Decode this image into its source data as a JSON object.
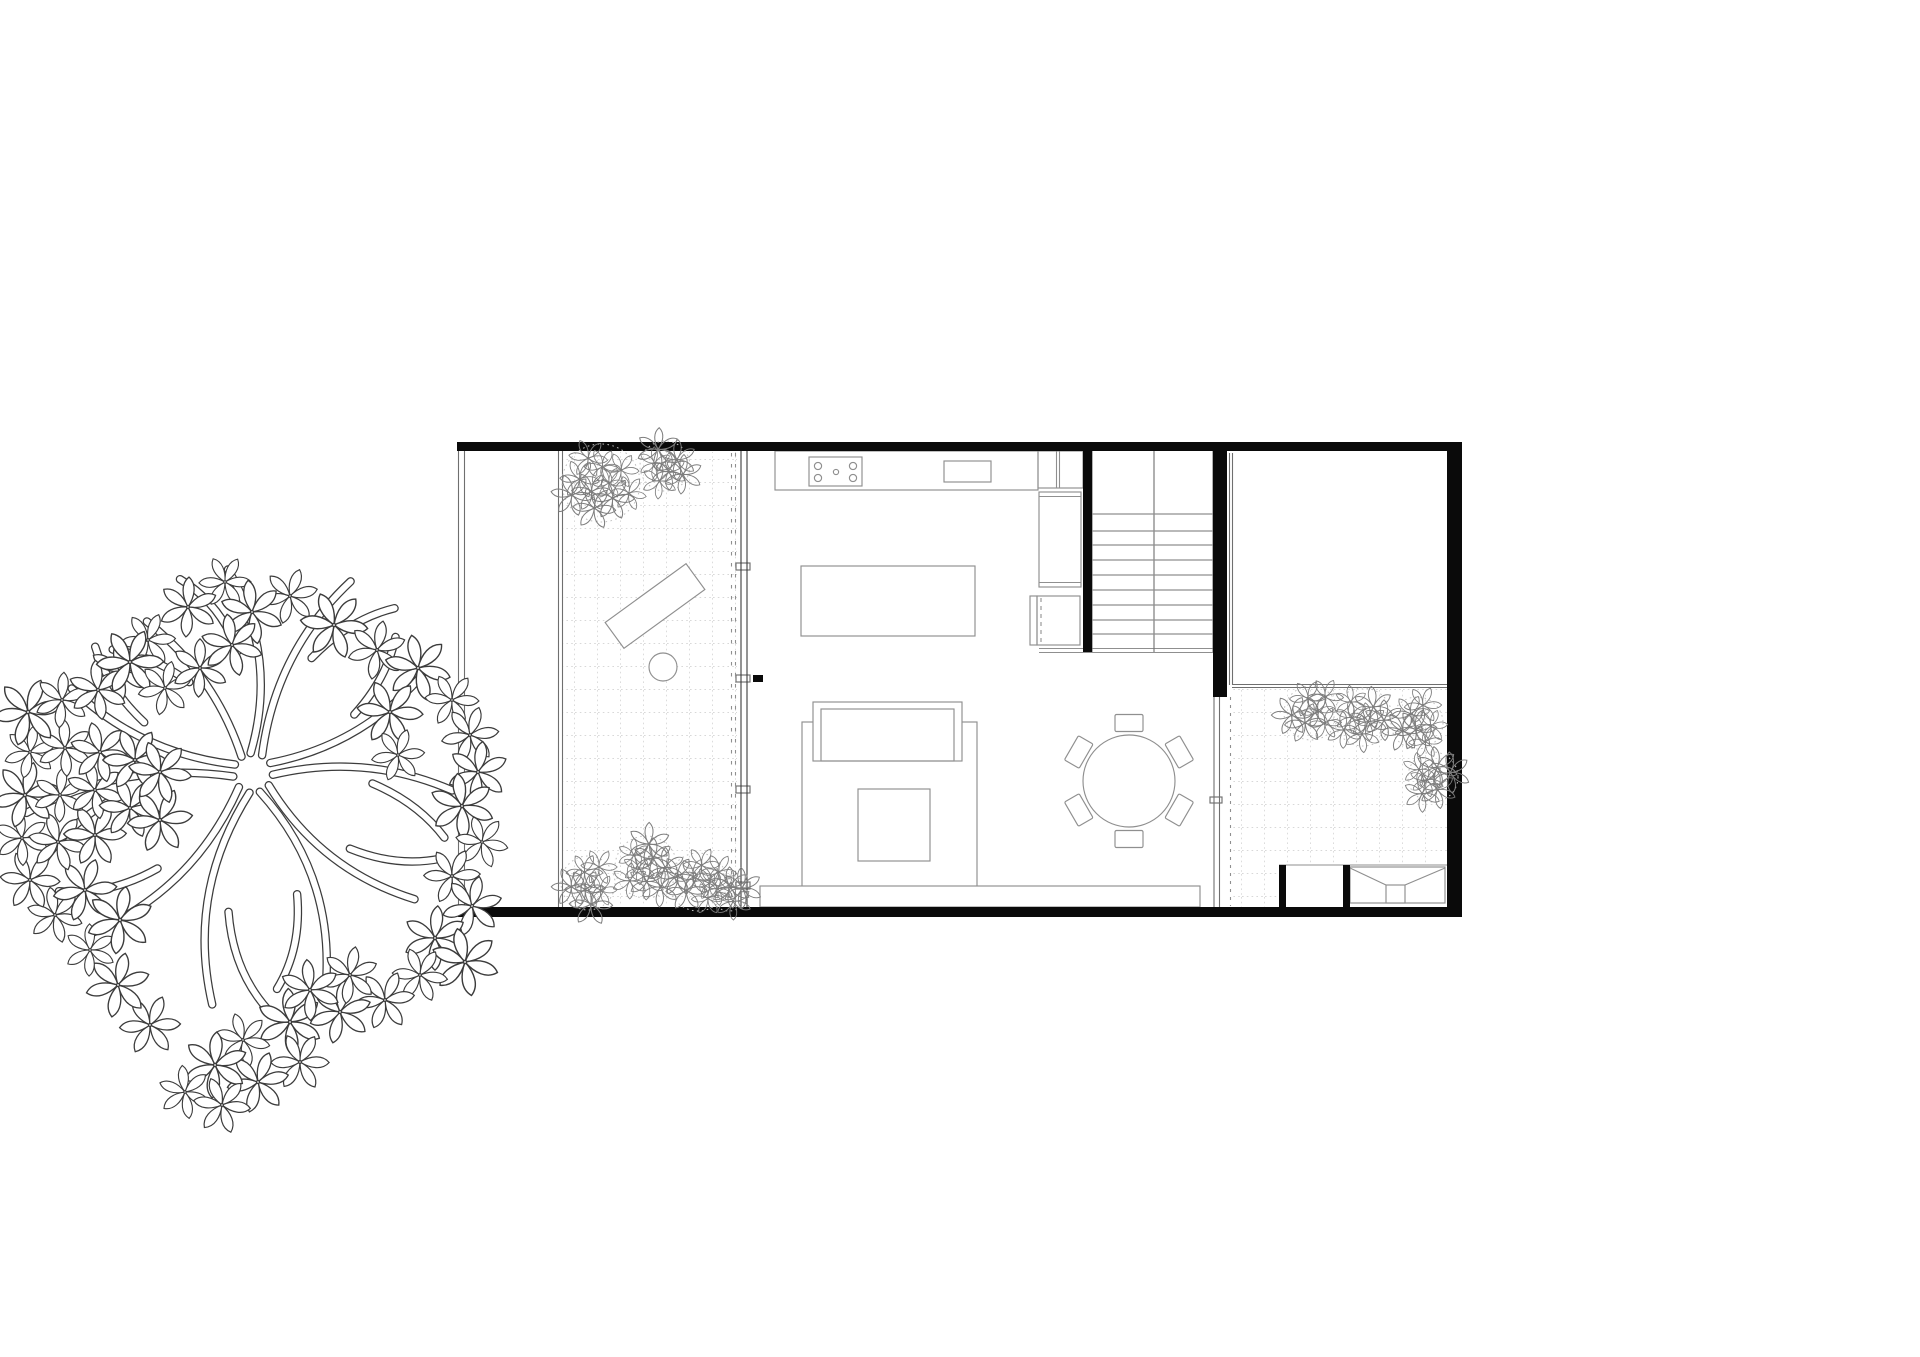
{
  "palette": {
    "paper": "#ffffff",
    "wall": "#0a0a0a",
    "line_strong": "#3c3c3c",
    "line_mid": "#6f6f6f",
    "line_soft": "#8f8f8f",
    "grid": "#d8d8d8",
    "foliage": "#7d7d7d",
    "foliage_halo": "#c0c0c0"
  },
  "canvas": {
    "w": 1920,
    "h": 1357
  },
  "legend": {
    "drawing": "house-floor-plan",
    "tree": "existing-tree",
    "west_courtyard": "paved-courtyard-with-planting",
    "east_courtyard": "paved-courtyard-with-planting",
    "stair_treads": 9,
    "cooktop_burners": 4,
    "dining_chairs": 6
  },
  "walls": [
    {
      "name": "wall-north",
      "x": 457,
      "y": 442,
      "w": 998,
      "h": 9
    },
    {
      "name": "wall-south",
      "x": 458,
      "y": 907,
      "w": 1004,
      "h": 10
    },
    {
      "name": "wall-east",
      "x": 1447,
      "y": 442,
      "w": 15,
      "h": 475
    },
    {
      "name": "wall-stair-west",
      "x": 1083,
      "y": 449,
      "w": 9,
      "h": 203
    },
    {
      "name": "wall-stair-east",
      "x": 1213,
      "y": 451,
      "w": 14,
      "h": 246
    },
    {
      "name": "pier-storage-west",
      "x": 1279,
      "y": 865,
      "w": 7,
      "h": 43
    },
    {
      "name": "pier-storage-mid",
      "x": 1343,
      "y": 865,
      "w": 7,
      "h": 43
    },
    {
      "name": "facade-post",
      "x": 753,
      "y": 675,
      "w": 10,
      "h": 7
    }
  ],
  "double_lines": [
    {
      "name": "site-boundary-west",
      "x1": 458.5,
      "y1": 442,
      "x2": 458.5,
      "y2": 917,
      "gap": 6,
      "c": "mid"
    },
    {
      "name": "courtyard-west-edge",
      "x1": 558.5,
      "y1": 451,
      "x2": 558.5,
      "y2": 907,
      "gap": 4,
      "c": "mid"
    },
    {
      "name": "glass-facade-west",
      "x1": 741,
      "y1": 451,
      "x2": 741,
      "y2": 907,
      "gap": 6,
      "c": "strong"
    },
    {
      "name": "glass-partition-east",
      "x1": 1229.5,
      "y1": 453,
      "x2": 1229.5,
      "y2": 685,
      "gap": 3,
      "c": "mid"
    },
    {
      "name": "court-divider-east",
      "x1": 1232,
      "y1": 684.5,
      "x2": 1449,
      "y2": 684.5,
      "gap": 3,
      "c": "mid"
    },
    {
      "name": "track-south-east",
      "x1": 1214,
      "y1": 697,
      "x2": 1214,
      "y2": 907,
      "gap": 5.5,
      "c": "mid"
    },
    {
      "name": "stair-base-line",
      "x1": 1039,
      "y1": 648.5,
      "x2": 1213,
      "y2": 648.5,
      "gap": 4,
      "c": "soft"
    },
    {
      "name": "cabinet-divider",
      "x1": 1056.5,
      "y1": 451,
      "x2": 1056.5,
      "y2": 488,
      "gap": 3,
      "c": "soft"
    }
  ],
  "dashed_lines": [
    {
      "name": "curtain-dash-a",
      "x1": 731.5,
      "y1": 453,
      "x2": 731.5,
      "y2": 905,
      "dash": "3.5,7.5",
      "c": "soft"
    },
    {
      "name": "curtain-dash-b",
      "x1": 735.5,
      "y1": 453,
      "x2": 735.5,
      "y2": 905,
      "dash": "3.5,7.5",
      "c": "soft"
    },
    {
      "name": "track-dash-east",
      "x1": 1230.5,
      "y1": 697,
      "x2": 1230.5,
      "y2": 906,
      "dash": "3,5",
      "c": "soft"
    },
    {
      "name": "oven-door-dash",
      "x1": 1041,
      "y1": 598,
      "x2": 1041,
      "y2": 644,
      "dash": "4,4",
      "c": "soft"
    }
  ],
  "lines": [
    {
      "name": "storage-top-line",
      "x1": 1279,
      "y1": 865,
      "x2": 1453,
      "y2": 865,
      "c": "soft"
    },
    {
      "name": "fireplace-diag-left",
      "x1": 1350,
      "y1": 868,
      "x2": 1386,
      "y2": 885,
      "c": "soft"
    },
    {
      "name": "fireplace-diag-right",
      "x1": 1445,
      "y1": 868,
      "x2": 1405,
      "y2": 885,
      "c": "soft"
    },
    {
      "name": "tall-cabinet-top-inner",
      "x1": 1039,
      "y1": 496.5,
      "x2": 1081,
      "y2": 496.5,
      "c": "soft"
    },
    {
      "name": "tall-cabinet-bottom-inner",
      "x1": 1039,
      "y1": 582.5,
      "x2": 1081,
      "y2": 582.5,
      "c": "soft"
    }
  ],
  "rects": [
    {
      "name": "kitchen-counter",
      "x": 775,
      "y": 451,
      "w": 263,
      "h": 39
    },
    {
      "name": "cabinet-cell",
      "x": 1038,
      "y": 451,
      "w": 45,
      "h": 37
    },
    {
      "name": "cooktop",
      "x": 809,
      "y": 457,
      "w": 53,
      "h": 29
    },
    {
      "name": "kitchen-sink",
      "x": 944,
      "y": 461,
      "w": 47,
      "h": 21
    },
    {
      "name": "kitchen-island",
      "x": 801,
      "y": 566,
      "w": 174,
      "h": 70,
      "fill": true
    },
    {
      "name": "tall-cabinet",
      "x": 1039,
      "y": 492,
      "w": 42,
      "h": 95
    },
    {
      "name": "oven",
      "x": 1037,
      "y": 596,
      "w": 43,
      "h": 49
    },
    {
      "name": "oven-side-panel",
      "x": 1030,
      "y": 596,
      "w": 7,
      "h": 49
    },
    {
      "name": "rug",
      "x": 802,
      "y": 722,
      "w": 175,
      "h": 166
    },
    {
      "name": "sofa-outer",
      "x": 813,
      "y": 702,
      "w": 149,
      "h": 59,
      "fill": true
    },
    {
      "name": "sofa-inner",
      "x": 821,
      "y": 709,
      "w": 133,
      "h": 52
    },
    {
      "name": "coffee-table",
      "x": 858,
      "y": 789,
      "w": 72,
      "h": 72,
      "fill": true
    },
    {
      "name": "floor-step",
      "x": 760,
      "y": 886,
      "w": 440,
      "h": 21,
      "fill": true
    },
    {
      "name": "fireplace-body",
      "x": 1350,
      "y": 867,
      "w": 95,
      "h": 36
    },
    {
      "name": "fireplace-core",
      "x": 1386,
      "y": 885,
      "w": 19,
      "h": 18,
      "fill": true
    },
    {
      "name": "facade-tick-1",
      "x": 736,
      "y": 563,
      "w": 14,
      "h": 7,
      "fill": true,
      "c": "mid"
    },
    {
      "name": "facade-tick-2",
      "x": 736,
      "y": 675,
      "w": 14,
      "h": 7,
      "fill": true,
      "c": "mid"
    },
    {
      "name": "facade-tick-3",
      "x": 736,
      "y": 786,
      "w": 14,
      "h": 7,
      "fill": true,
      "c": "mid"
    },
    {
      "name": "facade-tick-4",
      "x": 736,
      "y": 882,
      "w": 14,
      "h": 7,
      "fill": true,
      "c": "mid"
    },
    {
      "name": "track-tick",
      "x": 1210,
      "y": 797,
      "w": 12,
      "h": 6,
      "fill": true,
      "c": "mid"
    }
  ],
  "bench": {
    "cx": 655,
    "cy": 606,
    "w": 100,
    "h": 32,
    "rot": -36
  },
  "circles": [
    {
      "name": "patio-table",
      "cx": 663,
      "cy": 667,
      "r": 14
    },
    {
      "name": "burner-1",
      "cx": 818,
      "cy": 466,
      "r": 3.6
    },
    {
      "name": "burner-2",
      "cx": 853,
      "cy": 466,
      "r": 3.6
    },
    {
      "name": "burner-3",
      "cx": 818,
      "cy": 478,
      "r": 3.6
    },
    {
      "name": "burner-4",
      "cx": 853,
      "cy": 478,
      "r": 3.6
    },
    {
      "name": "burner-center",
      "cx": 836,
      "cy": 472,
      "r": 2.6
    }
  ],
  "dining": {
    "cx": 1129,
    "cy": 781,
    "r": 46,
    "chair_w": 28,
    "chair_h": 17,
    "chair_dist": 58,
    "angles": [
      -90,
      -30,
      30,
      90,
      150,
      210
    ]
  },
  "stairs": {
    "x1": 1092,
    "x2": 1213,
    "y_top": 449,
    "landing_y": 514,
    "tread_ys": [
      531,
      545,
      560,
      575,
      590,
      605,
      620,
      634
    ],
    "y_bottom": 652,
    "center_x": 1154
  },
  "grid_areas": [
    {
      "name": "courtyard-west-paving",
      "x": 563,
      "y": 452,
      "w": 174,
      "h": 454
    },
    {
      "name": "courtyard-east-paving",
      "x": 1233,
      "y": 688,
      "w": 214,
      "h": 176
    },
    {
      "name": "courtyard-east-paving-south",
      "x": 1233,
      "y": 864,
      "w": 46,
      "h": 43
    }
  ],
  "plant_clusters": [
    {
      "cx": 601,
      "cy": 483,
      "r": 39,
      "n": 10
    },
    {
      "cx": 665,
      "cy": 466,
      "r": 25,
      "n": 6
    },
    {
      "cx": 588,
      "cy": 883,
      "r": 27,
      "n": 6
    },
    {
      "cx": 646,
      "cy": 867,
      "r": 31,
      "n": 8
    },
    {
      "cx": 698,
      "cy": 882,
      "r": 29,
      "n": 7
    },
    {
      "cx": 729,
      "cy": 893,
      "r": 18,
      "n": 4
    },
    {
      "cx": 1311,
      "cy": 713,
      "r": 27,
      "n": 6
    },
    {
      "cx": 1363,
      "cy": 717,
      "r": 29,
      "n": 7
    },
    {
      "cx": 1417,
      "cy": 723,
      "r": 26,
      "n": 6
    },
    {
      "cx": 1433,
      "cy": 777,
      "r": 25,
      "n": 6
    }
  ],
  "tree": {
    "cx": 253,
    "cy": 773,
    "branches": [
      [
        -97,
        205,
        40
      ],
      [
        -63,
        215,
        -35
      ],
      [
        -30,
        195,
        30
      ],
      [
        5,
        200,
        -30
      ],
      [
        38,
        205,
        35
      ],
      [
        70,
        215,
        -40
      ],
      [
        100,
        235,
        45
      ],
      [
        135,
        225,
        -40
      ],
      [
        170,
        230,
        35
      ],
      [
        -155,
        200,
        -30
      ],
      [
        -125,
        185,
        25
      ]
    ],
    "flowers": [
      [
        225,
        582
      ],
      [
        290,
        596
      ],
      [
        188,
        607
      ],
      [
        252,
        612
      ],
      [
        334,
        625
      ],
      [
        148,
        640
      ],
      [
        377,
        650
      ],
      [
        120,
        672
      ],
      [
        418,
        668
      ],
      [
        452,
        700
      ],
      [
        470,
        735
      ],
      [
        478,
        772
      ],
      [
        462,
        806
      ],
      [
        482,
        842
      ],
      [
        452,
        876
      ],
      [
        472,
        906
      ],
      [
        435,
        938
      ],
      [
        465,
        962
      ],
      [
        420,
        975
      ],
      [
        385,
        1000
      ],
      [
        340,
        1012
      ],
      [
        290,
        1022
      ],
      [
        243,
        1040
      ],
      [
        300,
        1062
      ],
      [
        258,
        1082
      ],
      [
        215,
        1065
      ],
      [
        185,
        1092
      ],
      [
        222,
        1105
      ],
      [
        150,
        1025
      ],
      [
        118,
        985
      ],
      [
        90,
        950
      ],
      [
        55,
        915
      ],
      [
        30,
        880
      ],
      [
        85,
        890
      ],
      [
        120,
        920
      ],
      [
        22,
        838
      ],
      [
        58,
        842
      ],
      [
        95,
        835
      ],
      [
        25,
        795
      ],
      [
        60,
        795
      ],
      [
        95,
        790
      ],
      [
        130,
        808
      ],
      [
        160,
        820
      ],
      [
        30,
        752
      ],
      [
        65,
        748
      ],
      [
        100,
        752
      ],
      [
        135,
        760
      ],
      [
        28,
        712
      ],
      [
        62,
        700
      ],
      [
        98,
        690
      ],
      [
        160,
        772
      ],
      [
        130,
        662
      ],
      [
        165,
        688
      ],
      [
        200,
        668
      ],
      [
        232,
        645
      ],
      [
        390,
        712
      ],
      [
        398,
        755
      ],
      [
        350,
        975
      ],
      [
        310,
        990
      ]
    ]
  }
}
